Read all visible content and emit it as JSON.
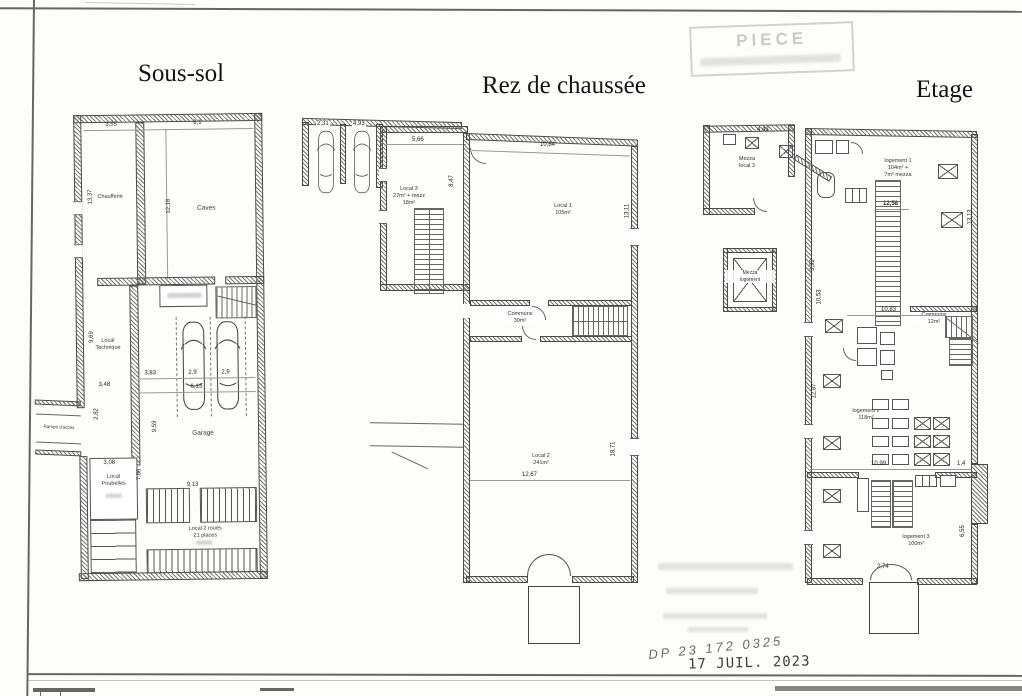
{
  "stamps": {
    "piece_stamp": "PIECE",
    "handwritten_ref": "DP 23 172 0325",
    "date_stamp": "17 JUIL. 2023"
  },
  "sous_sol": {
    "title": "Sous-sol",
    "rooms": {
      "chaufferie": "Chaufferie",
      "caves": "Caves",
      "local_technique": "Local\nTechnique",
      "garage": "Garage",
      "local_poubelles": "Local\nPoubelles",
      "local_2_roues": "Local 2 roues\n21 places",
      "rampe": "Rampe d'accès"
    },
    "dims": {
      "d355": "3,55",
      "d81": "8,1",
      "d1337": "13,37",
      "d1216": "12,16",
      "d383": "3,83",
      "d29a": "2,9",
      "d29b": "2,9",
      "d613": "6,13",
      "d969": "9,69",
      "d959": "9,59",
      "d282": "2,82",
      "d308": "3,08",
      "d786": "7,86",
      "d913": "9,13",
      "d348": "3,48"
    }
  },
  "rez": {
    "title": "Rez de chaussée",
    "rooms": {
      "local3": "Local 3\n27m² + mezz\n18m²",
      "local1": "Local 1\n105m²",
      "communs": "Communs\n30m²",
      "local2": "Local 2\n241m²"
    },
    "dims": {
      "d566": "5,66",
      "d847": "8,47",
      "d1064": "10,64",
      "d1311": "13,11",
      "d1267": "12,67",
      "d1871": "18,71",
      "p1": "2,31",
      "p2": "4,93"
    }
  },
  "etage": {
    "title": "Etage",
    "rooms": {
      "mezza_local3": "Mezza\nlocal 3",
      "mezza_logement": "Mezza\nlogement",
      "logement1": "logement 1\n104m² +\n7m² mezza",
      "communs": "Communs\n12m²",
      "logement2": "logement 2\n118m²",
      "logement3": "logement 3\n100m²"
    },
    "dims": {
      "d443": "4,43",
      "d1258": "12,58",
      "d1313": "13,13",
      "d1287": "12,87",
      "d1099": "10,99",
      "d14": "1,4",
      "d1083": "10,83",
      "d392": "3,92",
      "d1053": "10,53",
      "d274": "2,74",
      "d655": "6,55"
    }
  }
}
